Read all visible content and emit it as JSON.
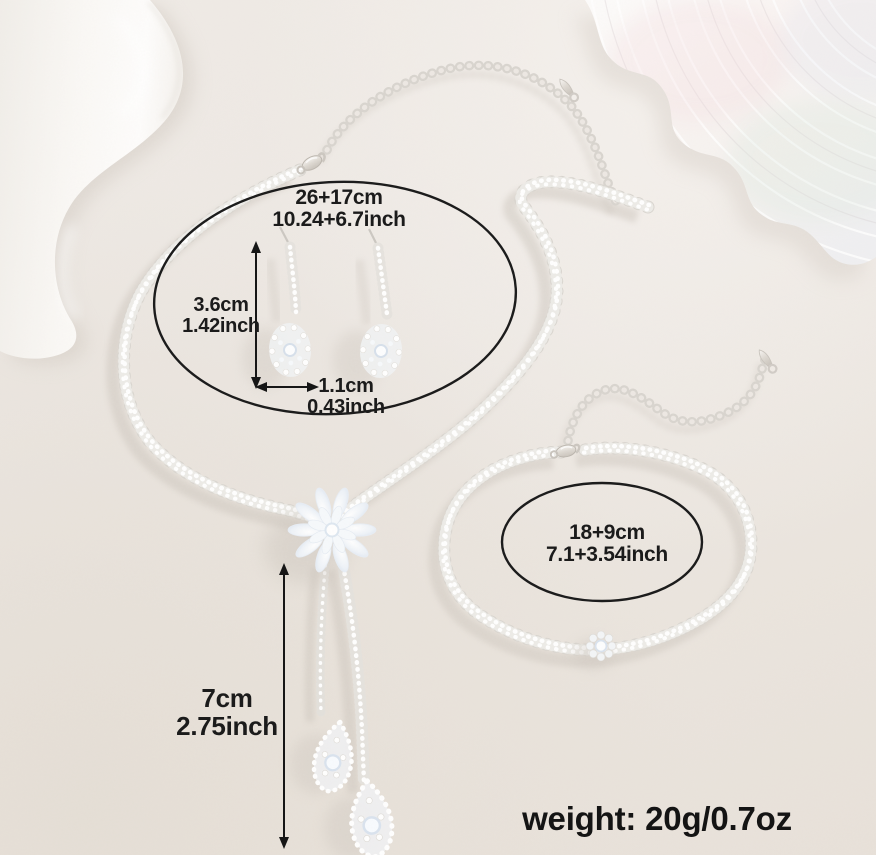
{
  "annotations": {
    "necklace_size": {
      "line1": "26+17cm",
      "line2": "10.24+6.7inch"
    },
    "earring_height": {
      "line1": "3.6cm",
      "line2": "1.42inch"
    },
    "earring_width": {
      "line1": "1.1cm",
      "line2": "0.43inch"
    },
    "pendant_drop": {
      "line1": "7cm",
      "line2": "2.75inch"
    },
    "bracelet_size": {
      "line1": "18+9cm",
      "line2": "7.1+3.54inch"
    },
    "weight": "weight: 20g/0.7oz"
  },
  "colors": {
    "background": "#ece7e2",
    "annotation_ink": "#1b1b1b",
    "metal_silver": "#d9d4cd",
    "crystal": "#eef2f7"
  }
}
